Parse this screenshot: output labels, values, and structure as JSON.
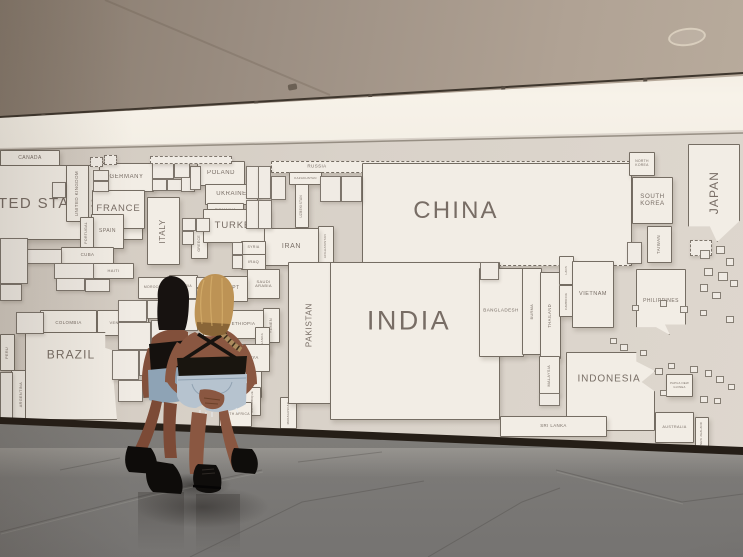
{
  "colors": {
    "map_background": "#d8d1c8",
    "country_fill": "#f2ede5",
    "country_border": "#5f564c",
    "label_color": "#6e635b",
    "ceiling": "#9b8e82",
    "cove_light": "#f7f2e9",
    "baseboard": "#251e17",
    "floor": "#8d8a86",
    "hair_dark": "#171210",
    "hair_blonde": "#bd9355",
    "skin": "#8a5741",
    "top_black": "#18140f",
    "denim": "#b6c3cf",
    "boots": "#0f0d0b"
  },
  "ceiling": {
    "track_light_count": 6,
    "fixtures": [
      {
        "x": 30,
        "y": 113
      },
      {
        "x": 137,
        "y": 107
      },
      {
        "x": 243,
        "y": 100
      },
      {
        "x": 357,
        "y": 93
      },
      {
        "x": 490,
        "y": 85
      },
      {
        "x": 632,
        "y": 77
      }
    ]
  },
  "map": {
    "countries": [
      {
        "i": "canada",
        "t": "CANADA",
        "x": 0,
        "y": 150,
        "w": 58,
        "h": 15,
        "fs": 5
      },
      {
        "i": "united-states",
        "t": "UNITED STATES",
        "x": -72,
        "y": 165,
        "w": 213,
        "h": 73,
        "fs": 15,
        "lx": 106,
        "ly": 38
      },
      {
        "i": "united-kingdom",
        "t": "UNITED KINGDOM",
        "x": 66,
        "y": 165,
        "w": 21,
        "h": 55,
        "fs": 4.5,
        "o": "v"
      },
      {
        "i": "germany",
        "t": "GERMANY",
        "x": 99,
        "y": 163,
        "w": 53,
        "h": 27,
        "fs": 6
      },
      {
        "i": "france",
        "t": "FRANCE",
        "x": 92,
        "y": 190,
        "w": 51,
        "h": 37,
        "fs": 9.5
      },
      {
        "i": "spain",
        "t": "SPAIN",
        "x": 91,
        "y": 214,
        "w": 31,
        "h": 33,
        "fs": 5
      },
      {
        "i": "portugal",
        "t": "PORTUGAL",
        "x": 80,
        "y": 217,
        "w": 12,
        "h": 30,
        "fs": 3.5,
        "o": "v"
      },
      {
        "i": "italy",
        "t": "ITALY",
        "x": 147,
        "y": 197,
        "w": 31,
        "h": 66,
        "fs": 8,
        "o": "v"
      },
      {
        "i": "poland",
        "t": "POLAND",
        "x": 197,
        "y": 161,
        "w": 46,
        "h": 23,
        "fs": 6
      },
      {
        "i": "ukraine",
        "t": "UKRAINE",
        "x": 205,
        "y": 184,
        "w": 51,
        "h": 19,
        "fs": 6
      },
      {
        "i": "romania",
        "t": "ROMANIA",
        "x": 207,
        "y": 203,
        "w": 35,
        "h": 12,
        "fs": 4
      },
      {
        "i": "greece",
        "t": "GREECE",
        "x": 191,
        "y": 228,
        "w": 15,
        "h": 29,
        "fs": 3.5,
        "o": "v"
      },
      {
        "i": "turkey",
        "t": "TURKEY",
        "x": 203,
        "y": 209,
        "w": 65,
        "h": 32,
        "fs": 9.5
      },
      {
        "i": "russia",
        "t": "RUSSIA",
        "x": 271,
        "y": 161,
        "w": 357,
        "h": 10,
        "fs": 4.5,
        "d": true,
        "lx": 45,
        "ly": 5
      },
      {
        "i": "kazakhstan",
        "t": "KAZAKHSTAN",
        "x": 289,
        "y": 172,
        "w": 31,
        "h": 11,
        "fs": 3
      },
      {
        "i": "uzbekistan",
        "t": "UZBEKISTAN",
        "x": 295,
        "y": 184,
        "w": 12,
        "h": 42,
        "fs": 3.2,
        "o": "v"
      },
      {
        "i": "afghanistan",
        "t": "AFGHANISTAN",
        "x": 318,
        "y": 226,
        "w": 14,
        "h": 38,
        "fs": 3,
        "o": "v"
      },
      {
        "i": "iran",
        "t": "IRAN",
        "x": 264,
        "y": 228,
        "w": 53,
        "h": 36,
        "fs": 7
      },
      {
        "i": "syria",
        "t": "SYRIA",
        "x": 241,
        "y": 241,
        "w": 23,
        "h": 12,
        "fs": 3.5
      },
      {
        "i": "iraq",
        "t": "IRAQ",
        "x": 241,
        "y": 254,
        "w": 23,
        "h": 14,
        "fs": 4
      },
      {
        "i": "saudi-arabia",
        "t": "SAUDI ARABIA",
        "x": 247,
        "y": 269,
        "w": 31,
        "h": 28,
        "fs": 4,
        "wr": true
      },
      {
        "i": "yemen",
        "t": "YEMEN",
        "x": 263,
        "y": 308,
        "w": 15,
        "h": 33,
        "fs": 3.8,
        "o": "v"
      },
      {
        "i": "egypt",
        "t": "EGYPT",
        "x": 212,
        "y": 276,
        "w": 34,
        "h": 24,
        "fs": 5
      },
      {
        "i": "morocco",
        "t": "MOROCCO",
        "x": 138,
        "y": 277,
        "w": 30,
        "h": 20,
        "fs": 3.4
      },
      {
        "i": "algeria",
        "t": "ALGERIA",
        "x": 169,
        "y": 275,
        "w": 27,
        "h": 22,
        "fs": 3.4
      },
      {
        "i": "sudan",
        "t": "SUDAN",
        "x": 203,
        "y": 308,
        "w": 19,
        "h": 29,
        "fs": 3.8,
        "o": "v"
      },
      {
        "i": "ethiopia",
        "t": "ETHIOPIA",
        "x": 223,
        "y": 310,
        "w": 39,
        "h": 27,
        "fs": 4.4
      },
      {
        "i": "uganda",
        "t": "UGANDA",
        "x": 255,
        "y": 327,
        "w": 13,
        "h": 24,
        "fs": 3,
        "o": "v"
      },
      {
        "i": "kenya",
        "t": "KENYA",
        "x": 231,
        "y": 344,
        "w": 37,
        "h": 26,
        "fs": 4.4
      },
      {
        "i": "tanzania",
        "t": "TANZANIA",
        "x": 217,
        "y": 371,
        "w": 43,
        "h": 25,
        "fs": 4.4
      },
      {
        "i": "mozambique",
        "t": "MOZAMBIQUE",
        "x": 245,
        "y": 387,
        "w": 14,
        "h": 27,
        "fs": 2.8,
        "o": "v"
      },
      {
        "i": "madagascar",
        "t": "MADAGASCAR",
        "x": 280,
        "y": 397,
        "w": 15,
        "h": 30,
        "fs": 2.8,
        "o": "v"
      },
      {
        "i": "south-africa",
        "t": "SOUTH AFRICA",
        "x": 219,
        "y": 402,
        "w": 31,
        "h": 23,
        "fs": 3.4,
        "wr": true
      },
      {
        "i": "cuba",
        "t": "CUBA",
        "x": 61,
        "y": 247,
        "w": 51,
        "h": 15,
        "fs": 4.4
      },
      {
        "i": "haiti",
        "t": "HAITI",
        "x": 93,
        "y": 263,
        "w": 39,
        "h": 14,
        "fs": 4
      },
      {
        "i": "colombia",
        "t": "COLOMBIA",
        "x": 40,
        "y": 310,
        "w": 55,
        "h": 24,
        "fs": 4.4
      },
      {
        "i": "venezuela",
        "t": "VENEZUELA",
        "x": 97,
        "y": 310,
        "w": 50,
        "h": 24,
        "fs": 4
      },
      {
        "i": "peru",
        "t": "PERU",
        "x": 0,
        "y": 334,
        "w": 13,
        "h": 35,
        "fs": 3.8,
        "o": "v"
      },
      {
        "i": "argentina",
        "t": "ARGENTINA",
        "x": 11,
        "y": 370,
        "w": 18,
        "h": 48,
        "fs": 3.8,
        "o": "v"
      },
      {
        "i": "brazil",
        "t": "BRAZIL",
        "x": 25,
        "y": 332,
        "w": 105,
        "h": 86,
        "fs": 12,
        "lx": 45,
        "ly": 22,
        "c": "polygon(0 0,75% 0,75% 18%,100% 28%,82% 44%,86% 100%,0 100%)"
      },
      {
        "i": "china",
        "t": "CHINA",
        "x": 362,
        "y": 163,
        "w": 268,
        "h": 101,
        "fs": 24,
        "lx": 93,
        "ly": 47,
        "db": true
      },
      {
        "i": "nepal",
        "t": "NEPAL",
        "x": 430,
        "y": 262,
        "w": 49,
        "h": 18,
        "fs": 4.6
      },
      {
        "i": "pakistan",
        "t": "PAKISTAN",
        "x": 288,
        "y": 262,
        "w": 42,
        "h": 140,
        "fs": 8,
        "o": "v",
        "lx": 21,
        "ly": 62
      },
      {
        "i": "india",
        "t": "INDIA",
        "x": 330,
        "y": 262,
        "w": 168,
        "h": 156,
        "fs": 27,
        "lx": 78,
        "ly": 58
      },
      {
        "i": "bangladesh",
        "t": "BANGLADESH",
        "x": 479,
        "y": 268,
        "w": 43,
        "h": 87,
        "fs": 4.6,
        "lx": 21,
        "ly": 42
      },
      {
        "i": "burma",
        "t": "BURMA",
        "x": 522,
        "y": 268,
        "w": 18,
        "h": 85,
        "fs": 3.8,
        "o": "v"
      },
      {
        "i": "thailand",
        "t": "THAILAND",
        "x": 540,
        "y": 272,
        "w": 19,
        "h": 85,
        "fs": 4.2,
        "o": "v"
      },
      {
        "i": "laos",
        "t": "LAOS",
        "x": 559,
        "y": 256,
        "w": 13,
        "h": 27,
        "fs": 2.8,
        "o": "v"
      },
      {
        "i": "cambodia",
        "t": "CAMBODIA",
        "x": 559,
        "y": 285,
        "w": 13,
        "h": 30,
        "fs": 2.8,
        "o": "v"
      },
      {
        "i": "vietnam",
        "t": "VIETNAM",
        "x": 572,
        "y": 261,
        "w": 40,
        "h": 65,
        "fs": 5.5
      },
      {
        "i": "philippines",
        "t": "PHILIPPINES",
        "x": 636,
        "y": 269,
        "w": 48,
        "h": 64,
        "fs": 5,
        "c": "polygon(0 0,100% 0,100% 84%,58% 84%,68% 100%,40% 88%,0 88%)"
      },
      {
        "i": "malaysia",
        "t": "MALAYSIA",
        "x": 539,
        "y": 356,
        "w": 19,
        "h": 37,
        "fs": 3.8,
        "o": "v"
      },
      {
        "i": "indonesia",
        "t": "INDONESIA",
        "x": 566,
        "y": 352,
        "w": 87,
        "h": 77,
        "fs": 10,
        "lx": 42,
        "ly": 27,
        "c": "polygon(0 0,79% 0,79% 12%,100% 24%,85% 38%,100% 50%,100% 100%,0 100%)"
      },
      {
        "i": "papua-new-guinea",
        "t": "PAPUA NEW GUINEA",
        "x": 666,
        "y": 374,
        "w": 25,
        "h": 21,
        "fs": 2.8,
        "wr": true
      },
      {
        "i": "australia",
        "t": "AUSTRALIA",
        "x": 655,
        "y": 412,
        "w": 37,
        "h": 29,
        "fs": 3.8
      },
      {
        "i": "new-zealand",
        "t": "NEW ZEALAND",
        "x": 695,
        "y": 417,
        "w": 12,
        "h": 30,
        "fs": 2.8,
        "o": "v"
      },
      {
        "i": "sri-lanka",
        "t": "SRI LANKA",
        "x": 500,
        "y": 416,
        "w": 105,
        "h": 19,
        "fs": 4.4
      },
      {
        "i": "north-korea",
        "t": "NORTH KOREA",
        "x": 629,
        "y": 152,
        "w": 24,
        "h": 22,
        "fs": 3.4,
        "wr": true
      },
      {
        "i": "south-korea",
        "t": "SOUTH KOREA",
        "x": 632,
        "y": 177,
        "w": 39,
        "h": 45,
        "fs": 6.2,
        "wr": true
      },
      {
        "i": "taiwan",
        "t": "TAIWAN",
        "x": 647,
        "y": 226,
        "w": 23,
        "h": 35,
        "fs": 4.4,
        "o": "v"
      },
      {
        "i": "japan",
        "t": "JAPAN",
        "x": 688,
        "y": 144,
        "w": 50,
        "h": 96,
        "fs": 12,
        "o": "v",
        "c": "polygon(0 0,100% 0,100% 78%,56% 100%,42% 84%,0 84%)"
      }
    ],
    "unlabeled_shapes": [
      [
        52,
        182,
        12,
        14
      ],
      [
        93,
        170,
        14,
        9
      ],
      [
        93,
        181,
        14,
        9
      ],
      [
        152,
        163,
        20,
        14
      ],
      [
        174,
        163,
        14,
        13
      ],
      [
        152,
        179,
        13,
        10
      ],
      [
        167,
        179,
        13,
        10
      ],
      [
        181,
        177,
        12,
        13
      ],
      [
        190,
        166,
        9,
        22
      ],
      [
        182,
        218,
        12,
        11
      ],
      [
        196,
        218,
        12,
        12
      ],
      [
        182,
        231,
        10,
        12
      ],
      [
        246,
        166,
        11,
        31
      ],
      [
        258,
        166,
        11,
        31
      ],
      [
        246,
        200,
        11,
        27
      ],
      [
        258,
        200,
        12,
        27
      ],
      [
        271,
        176,
        13,
        22
      ],
      [
        320,
        176,
        19,
        24
      ],
      [
        341,
        176,
        19,
        24
      ],
      [
        232,
        242,
        9,
        11
      ],
      [
        232,
        255,
        9,
        12
      ],
      [
        196,
        277,
        10,
        9
      ],
      [
        196,
        288,
        10,
        9
      ],
      [
        207,
        280,
        8,
        17
      ],
      [
        168,
        299,
        13,
        30
      ],
      [
        183,
        299,
        13,
        30
      ],
      [
        118,
        300,
        27,
        20
      ],
      [
        147,
        300,
        21,
        17
      ],
      [
        118,
        322,
        31,
        26
      ],
      [
        151,
        320,
        19,
        23
      ],
      [
        112,
        350,
        25,
        28
      ],
      [
        139,
        350,
        21,
        24
      ],
      [
        162,
        346,
        16,
        21
      ],
      [
        118,
        380,
        23,
        20
      ],
      [
        143,
        378,
        19,
        18
      ],
      [
        163,
        368,
        15,
        17
      ],
      [
        20,
        249,
        40,
        13
      ],
      [
        54,
        263,
        38,
        14
      ],
      [
        56,
        278,
        27,
        11
      ],
      [
        85,
        279,
        23,
        11
      ],
      [
        0,
        238,
        26,
        44
      ],
      [
        0,
        284,
        20,
        15
      ],
      [
        16,
        312,
        26,
        20
      ],
      [
        0,
        372,
        11,
        46
      ],
      [
        480,
        262,
        17,
        16
      ],
      [
        627,
        242,
        13,
        20
      ],
      [
        539,
        393,
        19,
        11
      ],
      [
        150,
        156,
        80,
        6,
        "d"
      ],
      [
        90,
        157,
        11,
        8,
        "d"
      ],
      [
        104,
        155,
        11,
        8,
        "d"
      ],
      [
        690,
        240,
        20,
        14,
        "d"
      ]
    ],
    "islands": [
      [
        700,
        250,
        8,
        7
      ],
      [
        716,
        246,
        7,
        6
      ],
      [
        726,
        258,
        6,
        6
      ],
      [
        704,
        268,
        7,
        6
      ],
      [
        718,
        272,
        8,
        7
      ],
      [
        700,
        284,
        6,
        6
      ],
      [
        730,
        280,
        6,
        5
      ],
      [
        712,
        292,
        7,
        5
      ],
      [
        660,
        300,
        5,
        5
      ],
      [
        680,
        306,
        6,
        5
      ],
      [
        700,
        310,
        5,
        4
      ],
      [
        726,
        316,
        6,
        5
      ],
      [
        655,
        368,
        6,
        5
      ],
      [
        668,
        363,
        5,
        4
      ],
      [
        690,
        366,
        6,
        5
      ],
      [
        705,
        370,
        5,
        5
      ],
      [
        716,
        376,
        6,
        5
      ],
      [
        728,
        384,
        5,
        4
      ],
      [
        700,
        396,
        6,
        5
      ],
      [
        714,
        398,
        5,
        4
      ],
      [
        660,
        390,
        5,
        4
      ],
      [
        640,
        350,
        5,
        4
      ],
      [
        620,
        344,
        6,
        5
      ],
      [
        610,
        338,
        5,
        4
      ],
      [
        632,
        305,
        5,
        4
      ]
    ]
  }
}
